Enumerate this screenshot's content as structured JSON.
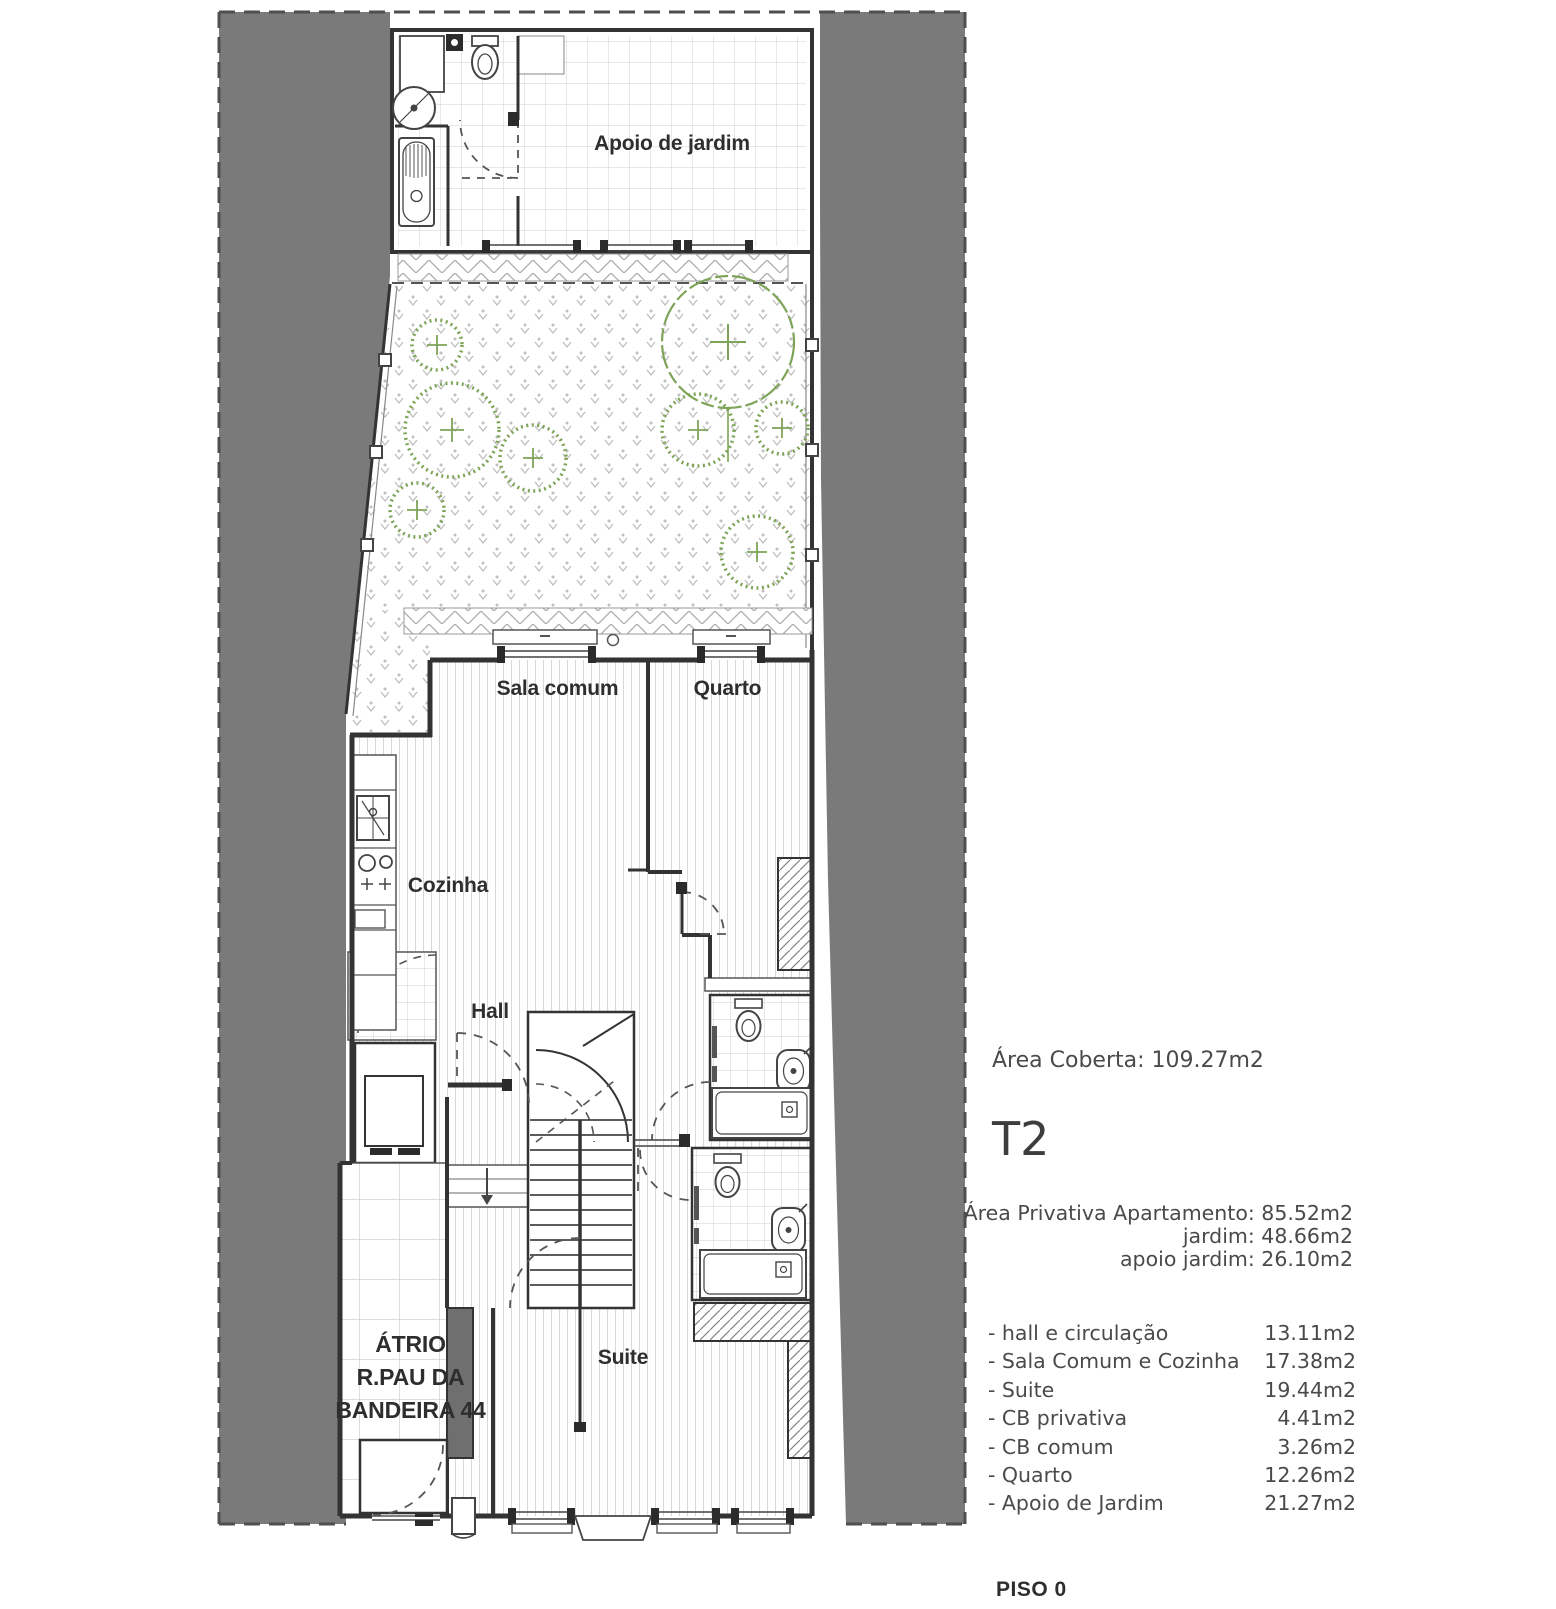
{
  "plan": {
    "labels": {
      "apoio": "Apoio de jardim",
      "sala": "Sala comum",
      "quarto": "Quarto",
      "cozinha": "Cozinha",
      "hall": "Hall",
      "suite": "Suite",
      "atrio_line1": "ÁTRIO",
      "atrio_line2": "R.PAU DA",
      "atrio_line3": "BANDEIRA 44"
    },
    "colors": {
      "neighbor_gray": "#7a7a7a",
      "wall": "#333333",
      "vegetation_green": "#7da457"
    }
  },
  "info": {
    "area_coberta": "Área Coberta: 109.27m2",
    "unit_type": "T2",
    "private_block": [
      "Área Privativa Apartamento: 85.52m2",
      "jardim: 48.66m2",
      "apoio jardim:  26.10m2"
    ],
    "rooms": [
      {
        "label": "- hall e circulação",
        "value": "13.11m2"
      },
      {
        "label": "- Sala Comum e Cozinha",
        "value": "17.38m2"
      },
      {
        "label": "- Suite",
        "value": "19.44m2"
      },
      {
        "label": "- CB privativa",
        "value": "4.41m2"
      },
      {
        "label": "- CB comum",
        "value": "3.26m2"
      },
      {
        "label": "- Quarto",
        "value": "12.26m2"
      },
      {
        "label": "- Apoio de Jardim",
        "value": "21.27m2"
      }
    ],
    "floor_label": "PISO 0"
  }
}
